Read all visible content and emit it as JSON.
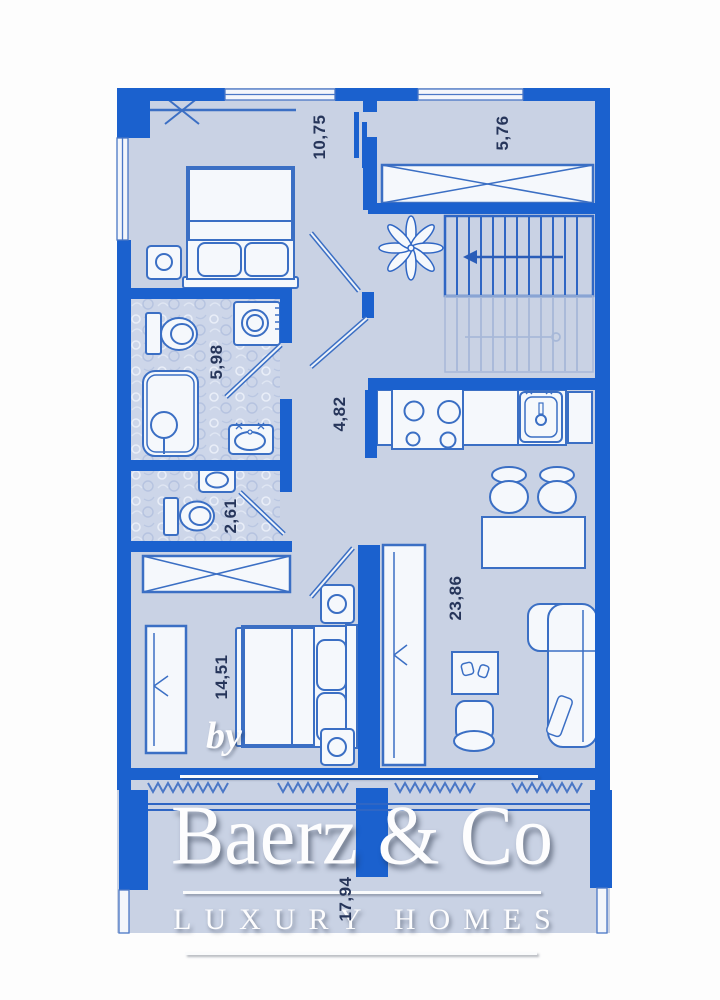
{
  "plan": {
    "type": "apartment-floor-plan",
    "rooms": [
      {
        "id": "bedroom-top",
        "area_label": "10,75"
      },
      {
        "id": "storage-top-right",
        "area_label": "5,76"
      },
      {
        "id": "bathroom",
        "area_label": "5,98"
      },
      {
        "id": "hallway",
        "area_label": "4,82"
      },
      {
        "id": "wc",
        "area_label": "2,61"
      },
      {
        "id": "bedroom-bottom",
        "area_label": "14,51"
      },
      {
        "id": "living-kitchen",
        "area_label": "23,86"
      },
      {
        "id": "terrace",
        "area_label": "17,94"
      }
    ],
    "icons": [
      "bed-icon",
      "nightstand-icon",
      "wardrobe-icon",
      "closet-rail-icon",
      "stairs-icon",
      "stairs-direction-arrow-icon",
      "plant-icon",
      "toilet-icon",
      "washing-machine-icon",
      "bathtub-icon",
      "sink-icon",
      "stove-icon",
      "kitchen-sink-icon",
      "kitchen-cabinet-icon",
      "dining-table-icon",
      "chair-icon",
      "coffee-table-icon",
      "armchair-icon",
      "sofa-icon",
      "door-leaf-icon",
      "window-icon",
      "balcony-railing-icon",
      "zigzag-boundary-icon"
    ]
  },
  "watermark": {
    "by": "by",
    "brand": "Baerz & Co",
    "tagline": "LUXURY HOMES"
  },
  "colors": {
    "wall": "#1b61ce",
    "floor": "#c9d2e4",
    "bath_pattern_base": "#cdd6e9",
    "furniture_fill": "#f5f8fc",
    "furniture_outline": "#3b6fc4",
    "stairs_faded": "#a7b8d8",
    "label_text": "#26355a",
    "watermark_text": "#fdfdfe"
  }
}
